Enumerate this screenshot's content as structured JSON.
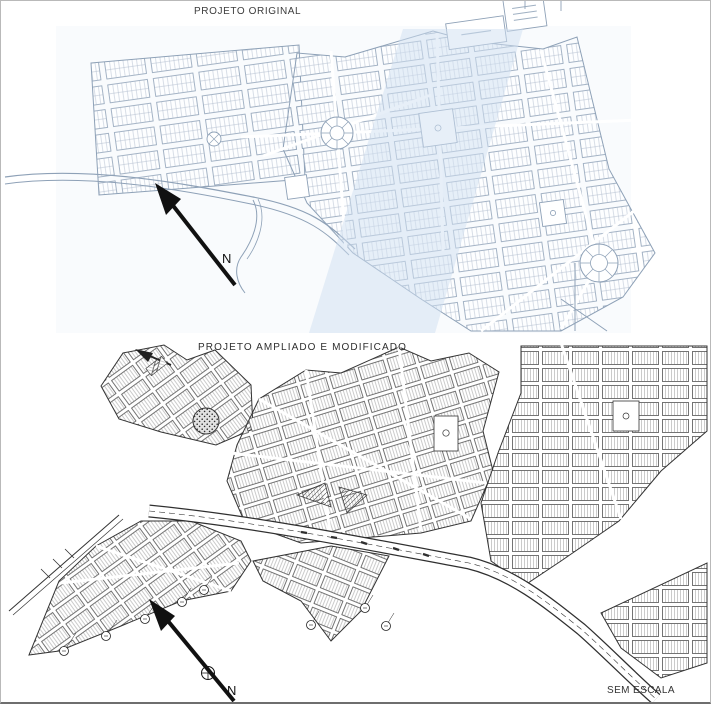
{
  "figure": {
    "kind": "scanned urban allotment plans, two stacked panels",
    "panels": {
      "original": {
        "title": "PROJETO ORIGINAL",
        "compass_label": "N"
      },
      "modified": {
        "title": "PROJETO AMPLIADO E MODIFICADO",
        "compass_label": "N",
        "scale_note": "SEM ESCALA"
      }
    },
    "icons": {
      "north_arrow": "long diagonal black arrow pointing up-left",
      "compass_rose": "small circle with cross on arrow shaft",
      "roundabout": "circle with radial spokes",
      "plaza": "white square with small circle glyph"
    },
    "colors": {
      "paper": "#ffffff",
      "ink_blue": "#8ea1b7",
      "ink_blue_light": "#aab8ca",
      "ink_black": "#2f2f2f",
      "band_blue": "#cfe0f2",
      "wash_blue": "#f2f6fb",
      "border_gray": "#b9b9b9"
    }
  }
}
